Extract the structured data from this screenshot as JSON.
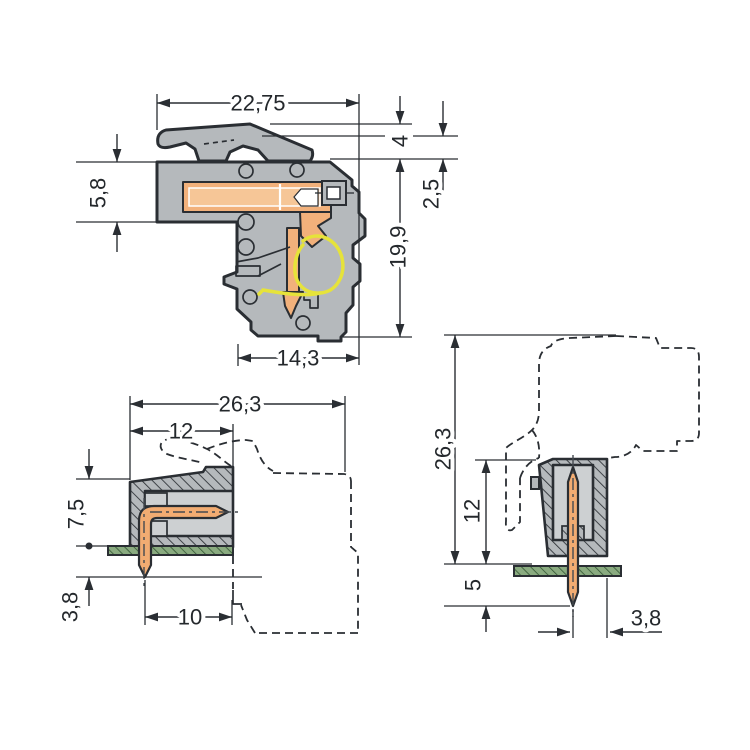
{
  "drawing": {
    "kind": "connector-dimensional-drawing",
    "colors": {
      "housing_gray": "#b5b9bc",
      "cavity_gray": "#cdd0d2",
      "contact_orange": "#f2b17b",
      "spring_yellow": "#e6e33a",
      "pcb_green": "#8aab80",
      "line_dark": "#2a2e33",
      "background": "#ffffff"
    }
  },
  "views": {
    "side_section": {
      "dims": {
        "total_width": "22,75",
        "latch_height": "4",
        "front_height": "5,8",
        "latch_offset": "2,5",
        "body_height": "19,9",
        "body_depth": "14,3"
      }
    },
    "angled_header": {
      "dims": {
        "total_depth": "26,3",
        "housing_depth": "12",
        "height_above_board": "7,5",
        "pin_length_below_board": "3,8",
        "pin_axis_to_face": "10"
      }
    },
    "vertical_header": {
      "dims": {
        "total_height": "26,3",
        "housing_height": "12",
        "pin_length_below_board": "5",
        "pin_axis_to_edge": "3,8"
      }
    }
  }
}
